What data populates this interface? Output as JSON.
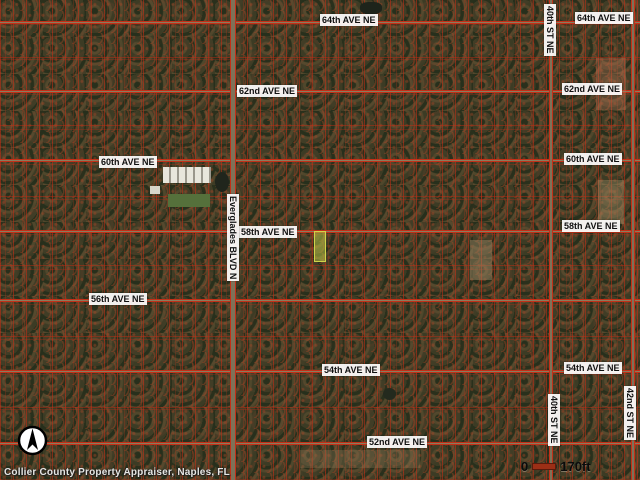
{
  "colors": {
    "parcel_line": "#c23018",
    "label_bg": "#ffffff",
    "label_text": "#101010",
    "highlight_parcel": "#cfd44a",
    "scale_bar": "#9c2f16"
  },
  "street_labels": [
    {
      "id": "lbl-64-left",
      "text": "64th AVE NE",
      "orientation": "horizontal"
    },
    {
      "id": "lbl-64-right",
      "text": "64th AVE NE",
      "orientation": "horizontal"
    },
    {
      "id": "lbl-62-left",
      "text": "62nd AVE NE",
      "orientation": "horizontal"
    },
    {
      "id": "lbl-62-right",
      "text": "62nd AVE NE",
      "orientation": "horizontal"
    },
    {
      "id": "lbl-60-left",
      "text": "60th AVE NE",
      "orientation": "horizontal"
    },
    {
      "id": "lbl-60-right",
      "text": "60th AVE NE",
      "orientation": "horizontal"
    },
    {
      "id": "lbl-58-mid",
      "text": "58th AVE NE",
      "orientation": "horizontal"
    },
    {
      "id": "lbl-58-right",
      "text": "58th AVE NE",
      "orientation": "horizontal"
    },
    {
      "id": "lbl-56-left",
      "text": "56th AVE NE",
      "orientation": "horizontal"
    },
    {
      "id": "lbl-54-mid",
      "text": "54th AVE NE",
      "orientation": "horizontal"
    },
    {
      "id": "lbl-54-right",
      "text": "54th AVE NE",
      "orientation": "horizontal"
    },
    {
      "id": "lbl-52-mid",
      "text": "52nd AVE NE",
      "orientation": "horizontal"
    },
    {
      "id": "lbl-evg",
      "text": "Everglades BLVD N",
      "orientation": "vertical"
    },
    {
      "id": "lbl-40-top",
      "text": "40th ST NE",
      "orientation": "vertical"
    },
    {
      "id": "lbl-40-bot",
      "text": "40th ST NE",
      "orientation": "vertical"
    },
    {
      "id": "lbl-42-bot",
      "text": "42nd ST NE",
      "orientation": "vertical"
    }
  ],
  "scale": {
    "start": "0",
    "end": "170ft"
  },
  "attribution": "Collier County Property Appraiser, Naples, FL"
}
